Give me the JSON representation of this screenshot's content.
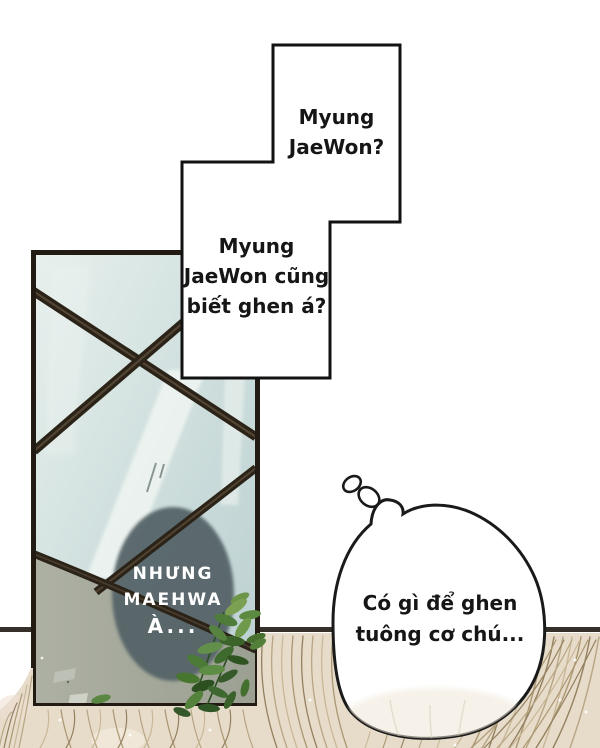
{
  "page": {
    "kind": "webtoon-comic-panel"
  },
  "bubbles": {
    "top": {
      "lines": [
        "Myung",
        "JaeWon?"
      ]
    },
    "mid": {
      "lines": [
        "Myung",
        "JaeWon cũng",
        "biết ghen á?"
      ]
    },
    "caption": {
      "lines": [
        "NHƯNG",
        "MAEHWA",
        "À..."
      ]
    },
    "thought": {
      "lines": [
        "Có gì để ghen",
        "tuông cơ chú..."
      ]
    }
  },
  "colors": {
    "background": "#ffffff",
    "outline": "#1a1a1a",
    "glass_light": "#e6efec",
    "glass_dark": "#bccfd1",
    "glass_gray_section": "#a7aa9c",
    "window_frame_bar": "#2b2318",
    "caption_ellipse": "#556468",
    "caption_text": "#ffffff",
    "wall_line": "#35312a",
    "hair_base": "#e7dcca",
    "hair_strand": "#a8946f",
    "leaf_green": "#53803a"
  }
}
